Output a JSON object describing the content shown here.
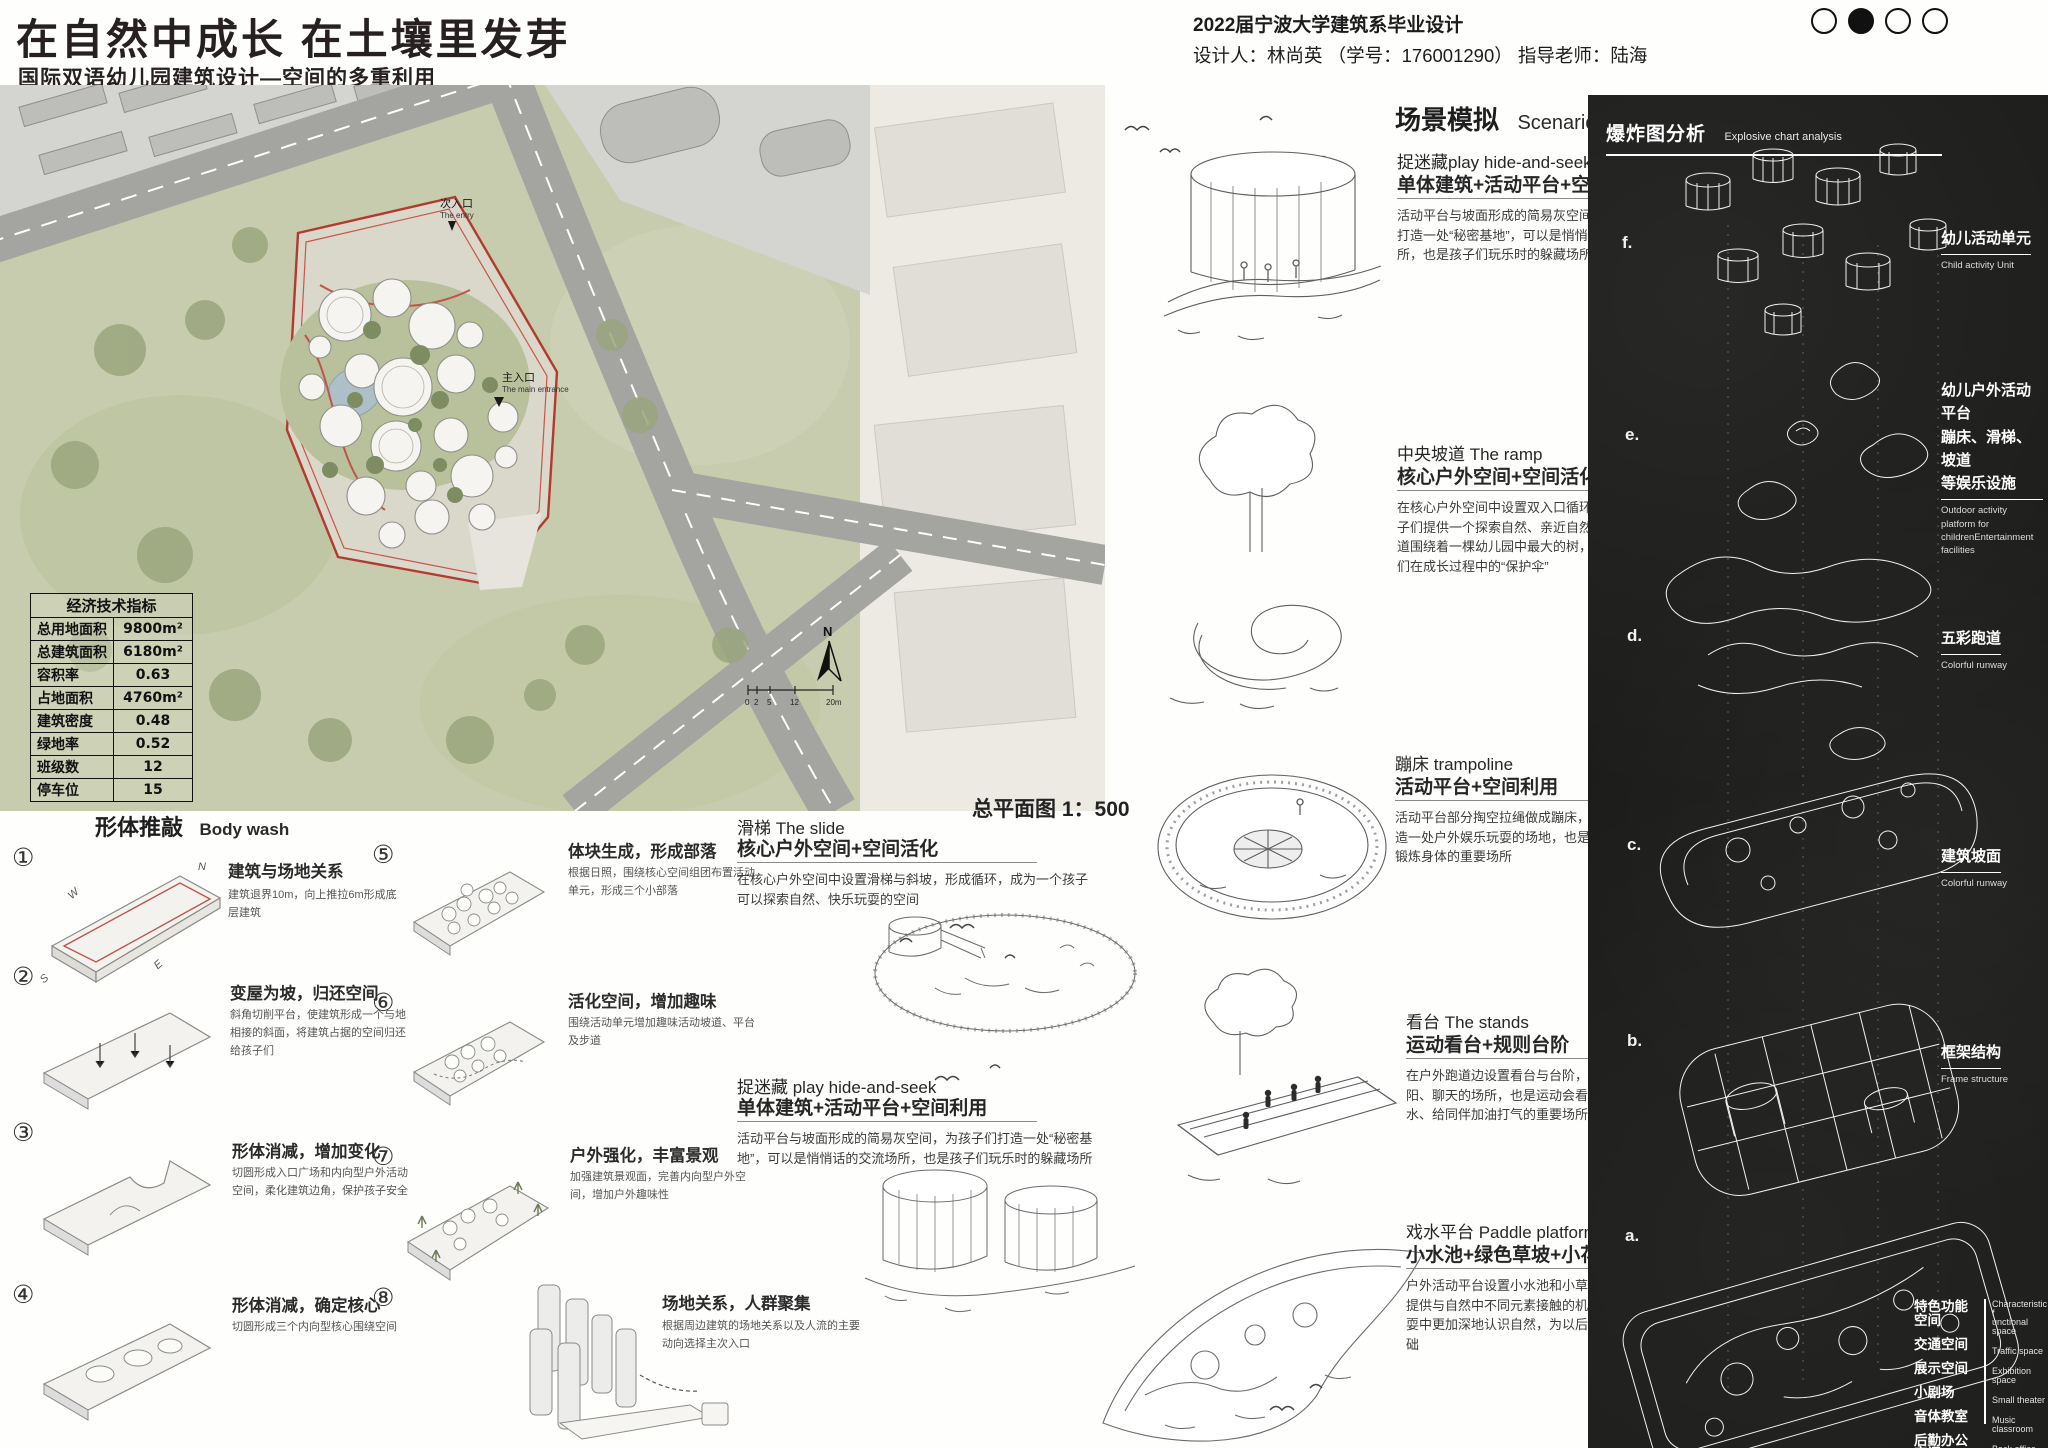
{
  "header": {
    "title": "在自然中成长  在土壤里发芽",
    "subtitle": "国际双语幼儿园建筑设计—空间的多重利用",
    "school_line": "2022届宁波大学建筑系毕业设计",
    "designer_line": "设计人：林尚英 （学号：176001290）  指导老师：陆海"
  },
  "site_plan": {
    "caption": "总平面图 1：500",
    "secondary_entry": "次入口",
    "secondary_entry_en": "The entry",
    "main_entry": "主入口",
    "main_entry_en": "The main entrance",
    "north_label": "N",
    "scale_ticks": {
      "t0": "0",
      "t1": "2",
      "t2": "5",
      "t3": "12",
      "t4": "20m"
    }
  },
  "indicators_table": {
    "title": "经济技术指标",
    "rows": [
      [
        "总用地面积",
        "9800m²"
      ],
      [
        "总建筑面积",
        "6180m²"
      ],
      [
        "容积率",
        "0.63"
      ],
      [
        "占地面积",
        "4760m²"
      ],
      [
        "建筑密度",
        "0.48"
      ],
      [
        "绿地率",
        "0.52"
      ],
      [
        "班级数",
        "12"
      ],
      [
        "停车位",
        "15"
      ]
    ]
  },
  "form_study": {
    "title": "形体推敲",
    "title_en": "Body wash",
    "items": [
      {
        "num": "①",
        "title": "建筑与场地关系",
        "desc": "建筑退界10m，向上推拉6m形成底层建筑"
      },
      {
        "num": "②",
        "title": "变屋为坡，归还空间",
        "desc": "斜角切削平台，使建筑形成一个与地相接的斜面，将建筑占据的空间归还给孩子们"
      },
      {
        "num": "③",
        "title": "形体消减，增加变化",
        "desc": "切圆形成入口广场和内向型户外活动空间，柔化建筑边角，保护孩子安全"
      },
      {
        "num": "④",
        "title": "形体消减，确定核心",
        "desc": "切圆形成三个内向型核心围绕空间"
      },
      {
        "num": "⑤",
        "title": "体块生成，形成部落",
        "desc": "根据日照，围绕核心空间组团布置活动单元，形成三个小部落"
      },
      {
        "num": "⑥",
        "title": "活化空间，增加趣味",
        "desc": "围绕活动单元增加趣味活动坡道、平台及步道"
      },
      {
        "num": "⑦",
        "title": "户外强化，丰富景观",
        "desc": "加强建筑景观面，完善内向型户外空间，增加户外趣味性"
      },
      {
        "num": "⑧",
        "title": "场地关系，人群聚集",
        "desc": "根据周边建筑的场地关系以及人流的主要动向选择主次入口"
      }
    ]
  },
  "mid_notes": [
    {
      "title": "滑梯  The slide",
      "subtitle": "核心户外空间+空间活化",
      "desc": "在核心户外空间中设置滑梯与斜坡，形成循环，成为一个孩子可以探索自然、快乐玩耍的空间"
    },
    {
      "title": "捉迷藏  play hide-and-seek",
      "subtitle": "单体建筑+活动平台+空间利用",
      "desc": "活动平台与坡面形成的简易灰空间，为孩子们打造一处“秘密基地”，可以是悄悄话的交流场所，也是孩子们玩乐时的躲藏场所"
    }
  ],
  "scenario": {
    "title": "场景模拟",
    "title_en": "Scenario simulation",
    "blocks": [
      {
        "title": "捉迷藏play hide-and-seek",
        "subtitle": "单体建筑+活动平台+空间利用",
        "desc": "活动平台与坡面形成的简易灰空间，为孩子们打造一处“秘密基地”，可以是悄悄话的交流场所，也是孩子们玩乐时的躲藏场所。"
      },
      {
        "title": "中央坡道  The ramp",
        "subtitle": "核心户外空间+空间活化",
        "desc": "在核心户外空间中设置双入口循环坡道，给孩子们提供一个探索自然、亲近自然的场所，坡道围绕着一棵幼儿园中最大的树，象征着孩子们在成长过程中的“保护伞”"
      },
      {
        "title": "蹦床  trampoline",
        "subtitle": "活动平台+空间利用",
        "desc": "活动平台部分掏空拉绳做成蹦床，为孩子们打造一处户外娱乐玩耍的场地，也是接触自然、锻炼身体的重要场所"
      },
      {
        "title": "看台  The stands",
        "subtitle": "运动看台+规则台阶",
        "desc": "在户外跑道边设置看台与台阶，是孩子们晒太阳、聊天的场所，也是运动会看孩子们挥洒汗水、给同伴加油打气的重要场所"
      },
      {
        "title": "戏水平台  Paddle platform",
        "subtitle": "小水池+绿色草坡+小花园",
        "desc": "户外活动平台设置小水池和小草坡，给孩子们提供与自然中不同元素接触的机会，可以在玩耍中更加深地认识自然，为以后的发育打下基础"
      }
    ]
  },
  "explode_panel": {
    "title": "爆炸图分析",
    "title_en": "Explosive chart analysis",
    "letters": [
      "f.",
      "e.",
      "d.",
      "c.",
      "b.",
      "a."
    ],
    "labels": [
      {
        "cn": "幼儿活动单元",
        "en": "Child activity Unit"
      },
      {
        "cn": "幼儿户外活动平台\n蹦床、滑梯、坡道\n等娱乐设施",
        "en": "Outdoor activity platform for\nchildrenEntertainment facilities"
      },
      {
        "cn": "五彩跑道",
        "en": "Colorful runway"
      },
      {
        "cn": "建筑坡面",
        "en": "Colorful runway"
      },
      {
        "cn": "框架结构",
        "en": "Frame structure"
      }
    ],
    "legend": [
      {
        "cn": "特色功能空间",
        "en": "Characteristic f\nunctional space"
      },
      {
        "cn": "交通空间",
        "en": "Traffic space"
      },
      {
        "cn": "展示空间",
        "en": "Exhibition space"
      },
      {
        "cn": "小剧场",
        "en": "Small theater"
      },
      {
        "cn": "音体教室",
        "en": "Music classroom"
      },
      {
        "cn": "后勤办公空间",
        "en": "Back office space"
      }
    ]
  }
}
